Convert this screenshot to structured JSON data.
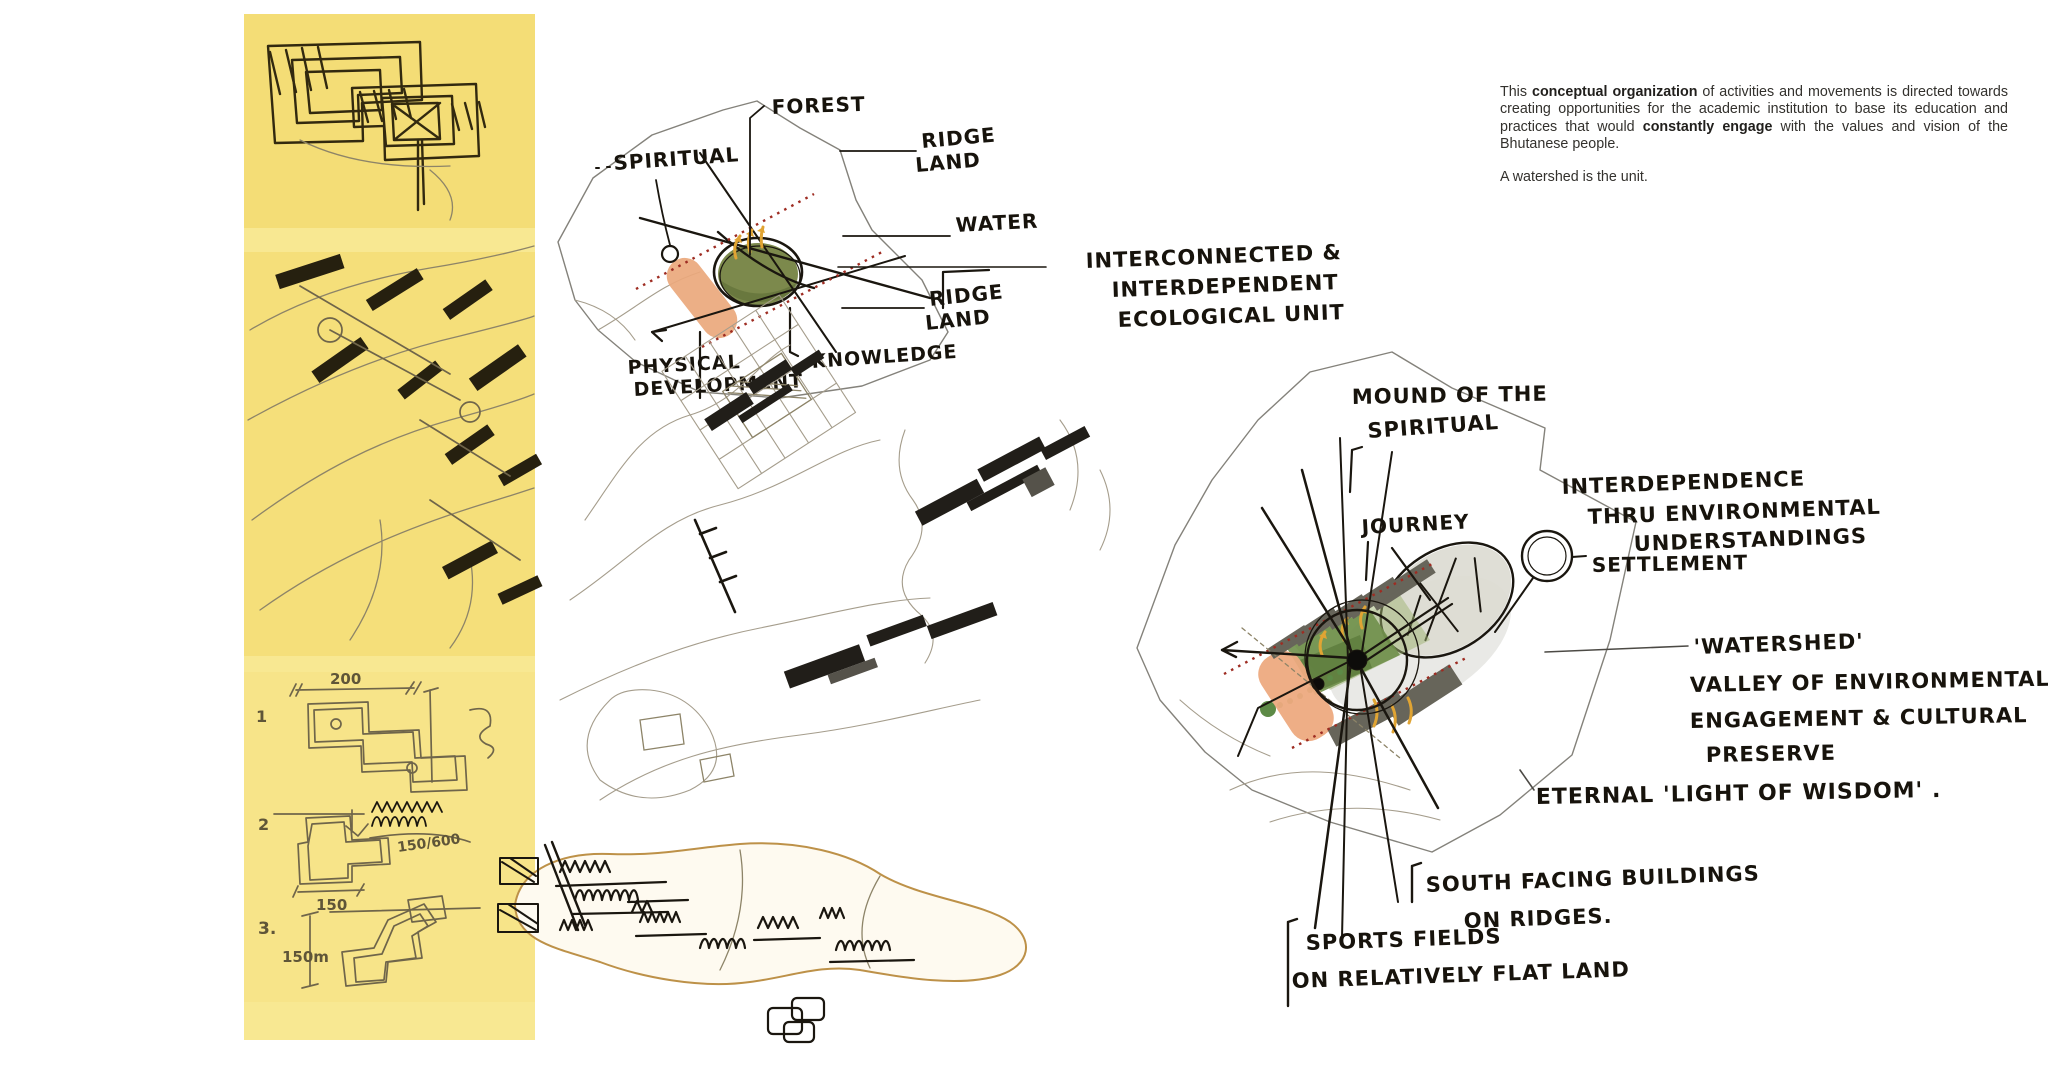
{
  "board": {
    "kind": "architectural concept board – watershed campus sketches",
    "background": "#ffffff"
  },
  "colors": {
    "trace_paper_yellow": "#f6e283",
    "ink_black": "#1a160f",
    "pencil_gray": "#a59d8c",
    "forest_green": "#7c894c",
    "valley_green": "#6f8f4a",
    "earth_orange": "#eba87d",
    "ridge_red_dotted": "#9e2c22",
    "flow_arrow_yellow": "#e0a433",
    "building_gray": "#67655a"
  },
  "trace_strip": {
    "annotations": {
      "n1": "1",
      "n2": "2",
      "n3": "3.",
      "dim_200": "200",
      "dim_150": "150",
      "dim_150m": "150m",
      "ratio_150_600": "150/600"
    }
  },
  "watershed_unit_diagram": {
    "forest": "FOREST",
    "spiritual": "SPIRITUAL",
    "ridge_land_upper": [
      "RIDGE",
      "LAND"
    ],
    "water": "WATER",
    "ridge_land_lower": [
      "RIDGE",
      "LAND"
    ],
    "knowledge": "KNOWLEDGE",
    "physical_development": [
      "PHYSICAL",
      "DEVELOPMENT"
    ],
    "eco_unit": [
      "INTERCONNECTED &",
      "INTERDEPENDENT",
      "ECOLOGICAL UNIT"
    ]
  },
  "watershed_valley_diagram": {
    "mound": [
      "MOUND OF THE",
      "SPIRITUAL"
    ],
    "journey": "JOURNEY",
    "interdependence": [
      "INTERDEPENDENCE",
      "THRU ENVIRONMENTAL",
      "UNDERSTANDINGS"
    ],
    "settlement": "SETTLEMENT",
    "watershed_valley": [
      "'WATERSHED'",
      "VALLEY OF ENVIRONMENTAL",
      "ENGAGEMENT & CULTURAL",
      "PRESERVE"
    ],
    "eternal": "ETERNAL 'LIGHT OF WISDOM' .",
    "south_facing": [
      "SOUTH FACING BUILDINGS",
      "ON RIDGES."
    ],
    "sports_fields": [
      "SPORTS FIELDS",
      "ON RELATIVELY FLAT LAND"
    ]
  },
  "concept_text": {
    "p1_1": "This ",
    "p1_bold1": "conceptual organization",
    "p1_2": " of activities and movements is directed towards creating opportunities for the academic institution to base its education and practices that would ",
    "p1_bold2": "constantly engage",
    "p1_3": " with the values and vision of the Bhutanese people.",
    "p2": "A watershed is the unit."
  }
}
